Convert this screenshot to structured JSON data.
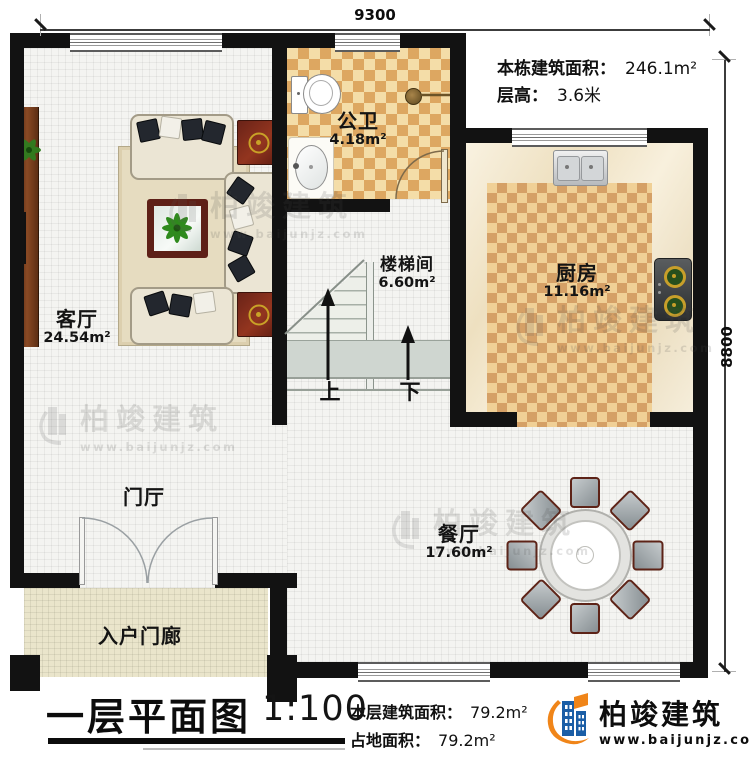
{
  "dimensions": {
    "top": "9300",
    "right": "8800"
  },
  "header": {
    "total_label": "本栋建筑面积：",
    "total_value": "246.1m²",
    "height_label": "层高：",
    "height_value": "3.6米"
  },
  "rooms": {
    "living": {
      "name": "客厅",
      "area": "24.54m²"
    },
    "bath": {
      "name": "公卫",
      "area": "4.18m²"
    },
    "stairwell": {
      "name": "楼梯间",
      "area": "6.60m²"
    },
    "kitchen": {
      "name": "厨房",
      "area": "11.16m²"
    },
    "dining": {
      "name": "餐厅",
      "area": "17.60m²"
    },
    "foyer": {
      "name": "门厅"
    },
    "porch": {
      "name": "入户门廊"
    }
  },
  "stairs": {
    "up": "上",
    "down": "下"
  },
  "footer": {
    "title": "一层平面图",
    "scale": "1:100",
    "floor_area_label": "本层建筑面积：",
    "floor_area_value": "79.2m²",
    "land_area_label": "占地面积：",
    "land_area_value": "79.2m²"
  },
  "brand": {
    "name": "柏竣建筑",
    "url": "www.baijunjz.com",
    "blue": "#1b5ea6",
    "orange": "#f08519"
  },
  "watermark": {
    "name": "柏竣建筑",
    "url": "www.baijunjz.com"
  }
}
